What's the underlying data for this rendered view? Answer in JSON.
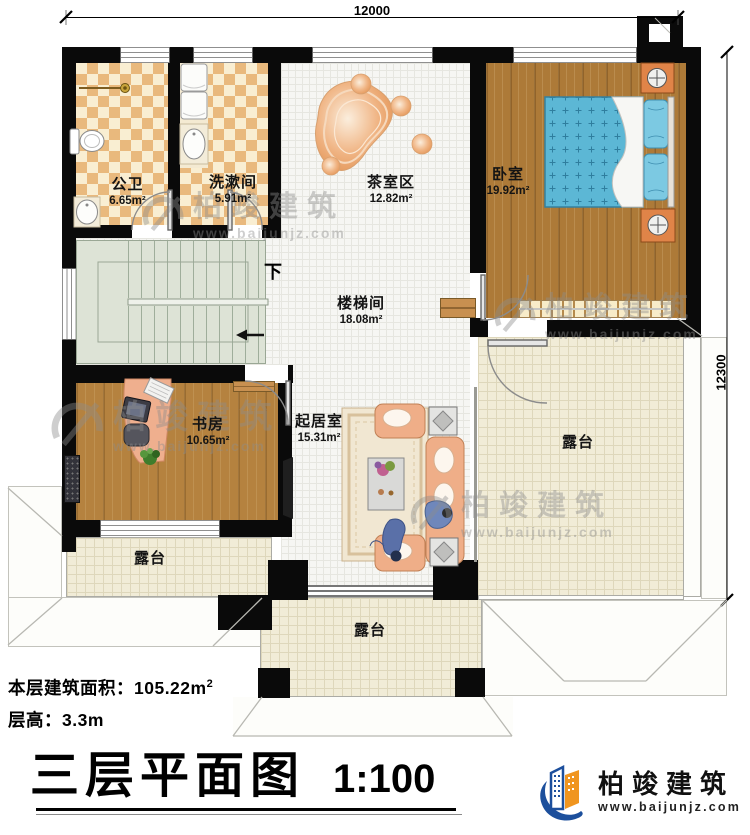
{
  "dimensions": {
    "top": "12000",
    "right": "12300"
  },
  "rooms": [
    {
      "name": "公卫",
      "area": "6.65m²"
    },
    {
      "name": "洗漱间",
      "area": "5.91m²"
    },
    {
      "name": "茶室区",
      "area": "12.82m²"
    },
    {
      "name": "卧室",
      "area": "19.92m²"
    },
    {
      "name": "楼梯间",
      "area": "18.08m²"
    },
    {
      "name": "书房",
      "area": "10.65m²"
    },
    {
      "name": "起居室",
      "area": "15.31m²"
    },
    {
      "name": "露台"
    },
    {
      "name": "露台"
    },
    {
      "name": "露台"
    }
  ],
  "stairs": {
    "down": "下"
  },
  "footer": {
    "area_label": "本层建筑面积：",
    "area_value": "105.22m",
    "area_sup": "2",
    "floor_height": "层高：3.3m",
    "title": "三层平面图",
    "scale": "1:100"
  },
  "brand": {
    "name": "柏竣建筑",
    "site": "www.baijunjz.com"
  },
  "colors": {
    "wall": "#0a0a0a",
    "wood": "#b5823f",
    "terrace": "#f1ecd7",
    "logo_blue": "#1c4f9c",
    "logo_orange": "#f0951f"
  }
}
